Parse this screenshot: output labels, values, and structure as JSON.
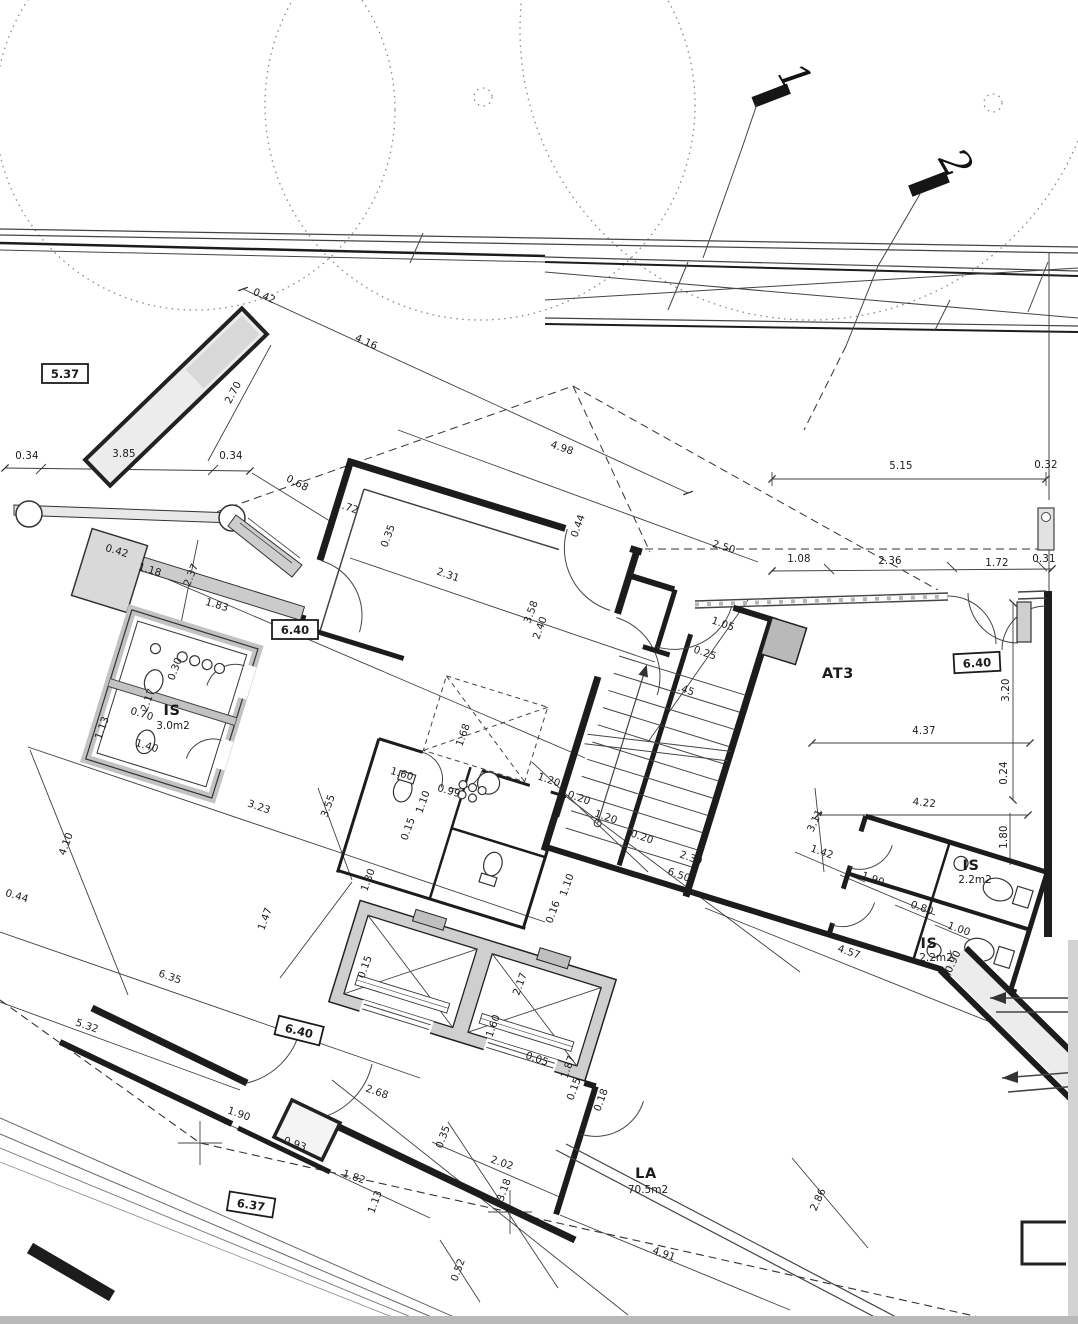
{
  "drawing": {
    "kind": "scanned architectural floor plan",
    "rooms": [
      {
        "name": "IS",
        "area": "3.0m2"
      },
      {
        "name": "AT3",
        "area": ""
      },
      {
        "name": "IS",
        "area": "2.2m2"
      },
      {
        "name": "IS",
        "area": "2.2m2"
      },
      {
        "name": "LA",
        "area": "70.5m2"
      }
    ],
    "level_markers": [
      "5.37",
      "6.40",
      "6.40",
      "6.40",
      "6.37"
    ],
    "section_markers": [
      "1",
      "2"
    ]
  },
  "labels": [
    {
      "t": "0.42",
      "x": 263,
      "y": 299,
      "r": 24,
      "cls": "dim"
    },
    {
      "t": "4.16",
      "x": 365,
      "y": 345,
      "r": 24,
      "cls": "dim"
    },
    {
      "t": "2.70",
      "x": 236,
      "y": 394,
      "r": -62,
      "cls": "dim"
    },
    {
      "t": "0.34",
      "x": 27,
      "y": 459,
      "r": 0,
      "cls": "dim"
    },
    {
      "t": "3.85",
      "x": 124,
      "y": 457,
      "r": 0,
      "cls": "dim"
    },
    {
      "t": "0.34",
      "x": 231,
      "y": 459,
      "r": 0,
      "cls": "dim"
    },
    {
      "t": "0.68",
      "x": 296,
      "y": 486,
      "r": 27,
      "cls": "dim"
    },
    {
      "t": "4.98",
      "x": 561,
      "y": 451,
      "r": 19,
      "cls": "dim"
    },
    {
      "t": "5.15",
      "x": 901,
      "y": 469,
      "r": 0,
      "cls": "dim"
    },
    {
      "t": "0.32",
      "x": 1046,
      "y": 468,
      "r": 0,
      "cls": "dim",
      "s": 8.5
    },
    {
      "t": "1.72",
      "x": 346,
      "y": 510,
      "r": 19,
      "cls": "dim"
    },
    {
      "t": "0.42",
      "x": 116,
      "y": 554,
      "r": 17,
      "cls": "dim",
      "s": 9.5
    },
    {
      "t": "1.18",
      "x": 149,
      "y": 573,
      "r": 17,
      "cls": "dim"
    },
    {
      "t": "2.37",
      "x": 194,
      "y": 576,
      "r": -68,
      "cls": "dim"
    },
    {
      "t": "1.83",
      "x": 216,
      "y": 608,
      "r": 17,
      "cls": "dim"
    },
    {
      "t": "0.35",
      "x": 391,
      "y": 537,
      "r": -70,
      "cls": "dim",
      "s": 9
    },
    {
      "t": "2.31",
      "x": 447,
      "y": 578,
      "r": 19,
      "cls": "dim"
    },
    {
      "t": "0.44",
      "x": 581,
      "y": 527,
      "r": -70,
      "cls": "dim",
      "s": 9
    },
    {
      "t": "2.50",
      "x": 723,
      "y": 550,
      "r": 17,
      "cls": "dim"
    },
    {
      "t": "1.08",
      "x": 799,
      "y": 562,
      "r": 0,
      "cls": "dim"
    },
    {
      "t": "2.36",
      "x": 890,
      "y": 564,
      "r": 0,
      "cls": "dim"
    },
    {
      "t": "1.72",
      "x": 997,
      "y": 566,
      "r": 0,
      "cls": "dim"
    },
    {
      "t": "0.31",
      "x": 1044,
      "y": 562,
      "r": 0,
      "cls": "dim",
      "s": 8.5
    },
    {
      "t": "3.58",
      "x": 534,
      "y": 613,
      "r": -70,
      "cls": "dim",
      "s": 9.5
    },
    {
      "t": "2.40",
      "x": 543,
      "y": 629,
      "r": -70,
      "cls": "dim",
      "s": 9.5
    },
    {
      "t": "1.05",
      "x": 722,
      "y": 627,
      "r": 19,
      "cls": "dim"
    },
    {
      "t": "0.25",
      "x": 704,
      "y": 656,
      "r": 19,
      "cls": "dim",
      "s": 9
    },
    {
      "t": "1.45",
      "x": 682,
      "y": 692,
      "r": 19,
      "cls": "dim"
    },
    {
      "t": "1.68",
      "x": 466,
      "y": 736,
      "r": -70,
      "cls": "dim",
      "s": 9.5
    },
    {
      "t": "0.30",
      "x": 178,
      "y": 670,
      "r": -70,
      "cls": "dim",
      "s": 9
    },
    {
      "t": "2.17",
      "x": 151,
      "y": 701,
      "r": -70,
      "cls": "dim"
    },
    {
      "t": "0.70",
      "x": 141,
      "y": 717,
      "r": 17,
      "cls": "dim",
      "s": 9
    },
    {
      "t": "1.40",
      "x": 146,
      "y": 749,
      "r": 17,
      "cls": "dim"
    },
    {
      "t": "1.13",
      "x": 105,
      "y": 729,
      "r": -70,
      "cls": "dim",
      "s": 9
    },
    {
      "t": "1.60",
      "x": 401,
      "y": 777,
      "r": 17,
      "cls": "dim",
      "s": 9
    },
    {
      "t": "0.99",
      "x": 448,
      "y": 794,
      "r": 17,
      "cls": "dim",
      "s": 9.5
    },
    {
      "t": "1.10",
      "x": 426,
      "y": 803,
      "r": -70,
      "cls": "dim",
      "s": 9.5
    },
    {
      "t": "0.15",
      "x": 411,
      "y": 830,
      "r": -70,
      "cls": "dim",
      "s": 9
    },
    {
      "t": "1.80",
      "x": 371,
      "y": 881,
      "r": -70,
      "cls": "dim"
    },
    {
      "t": "1.20",
      "x": 548,
      "y": 783,
      "r": 19,
      "cls": "dim"
    },
    {
      "t": "0.20",
      "x": 578,
      "y": 801,
      "r": 19,
      "cls": "dim"
    },
    {
      "t": "1.20",
      "x": 605,
      "y": 820,
      "r": 19,
      "cls": "dim"
    },
    {
      "t": "0.20",
      "x": 641,
      "y": 840,
      "r": 19,
      "cls": "dim",
      "s": 9
    },
    {
      "t": "1.10",
      "x": 570,
      "y": 886,
      "r": -70,
      "cls": "dim"
    },
    {
      "t": "0.16",
      "x": 556,
      "y": 913,
      "r": -70,
      "cls": "dim",
      "s": 9
    },
    {
      "t": "2.30",
      "x": 690,
      "y": 861,
      "r": 19,
      "cls": "dim",
      "s": 9.5
    },
    {
      "t": "6.50",
      "x": 678,
      "y": 878,
      "r": 19,
      "cls": "dim"
    },
    {
      "t": "3.23",
      "x": 258,
      "y": 810,
      "r": 19,
      "cls": "dim"
    },
    {
      "t": "3.55",
      "x": 331,
      "y": 807,
      "r": -70,
      "cls": "dim"
    },
    {
      "t": "4.10",
      "x": 69,
      "y": 845,
      "r": -70,
      "cls": "dim"
    },
    {
      "t": "0.44",
      "x": 16,
      "y": 899,
      "r": 17,
      "cls": "dim",
      "s": 9
    },
    {
      "t": "1.47",
      "x": 268,
      "y": 920,
      "r": -70,
      "cls": "dim"
    },
    {
      "t": "6.35",
      "x": 169,
      "y": 980,
      "r": 19,
      "cls": "dim"
    },
    {
      "t": "5.32",
      "x": 86,
      "y": 1029,
      "r": 19,
      "cls": "dim"
    },
    {
      "t": "0.15",
      "x": 368,
      "y": 968,
      "r": -70,
      "cls": "dim",
      "s": 9
    },
    {
      "t": "2.17",
      "x": 523,
      "y": 985,
      "r": -70,
      "cls": "dim"
    },
    {
      "t": "1.60",
      "x": 496,
      "y": 1027,
      "r": -70,
      "cls": "dim",
      "s": 9.5
    },
    {
      "t": "0.05",
      "x": 536,
      "y": 1062,
      "r": 19,
      "cls": "dim",
      "s": 8.5
    },
    {
      "t": "1.87",
      "x": 571,
      "y": 1068,
      "r": -70,
      "cls": "dim",
      "s": 9.5
    },
    {
      "t": "0.15",
      "x": 577,
      "y": 1090,
      "r": -70,
      "cls": "dim",
      "s": 8.5
    },
    {
      "t": "0.18",
      "x": 604,
      "y": 1101,
      "r": -70,
      "cls": "dim",
      "s": 8.5
    },
    {
      "t": "2.68",
      "x": 376,
      "y": 1095,
      "r": 19,
      "cls": "dim"
    },
    {
      "t": "0.35",
      "x": 446,
      "y": 1138,
      "r": -70,
      "cls": "dim",
      "s": 9.5
    },
    {
      "t": "2.02",
      "x": 501,
      "y": 1166,
      "r": 19,
      "cls": "dim"
    },
    {
      "t": "3.18",
      "x": 507,
      "y": 1191,
      "r": -70,
      "cls": "dim"
    },
    {
      "t": "1.82",
      "x": 353,
      "y": 1180,
      "r": 19,
      "cls": "dim"
    },
    {
      "t": "1.13",
      "x": 378,
      "y": 1203,
      "r": -70,
      "cls": "dim",
      "s": 9
    },
    {
      "t": "0.52",
      "x": 461,
      "y": 1271,
      "r": -70,
      "cls": "dim"
    },
    {
      "t": "1.90",
      "x": 238,
      "y": 1117,
      "r": 19,
      "cls": "dim"
    },
    {
      "t": "0.93",
      "x": 294,
      "y": 1147,
      "r": 19,
      "cls": "dim"
    },
    {
      "t": "4.91",
      "x": 663,
      "y": 1257,
      "r": 19,
      "cls": "dim"
    },
    {
      "t": "2.86",
      "x": 821,
      "y": 1201,
      "r": -65,
      "cls": "dim"
    },
    {
      "t": "3.11",
      "x": 818,
      "y": 822,
      "r": -65,
      "cls": "dim"
    },
    {
      "t": "4.22",
      "x": 924,
      "y": 806,
      "r": 6,
      "cls": "dim"
    },
    {
      "t": "1.42",
      "x": 821,
      "y": 855,
      "r": 19,
      "cls": "dim"
    },
    {
      "t": "1.90",
      "x": 872,
      "y": 882,
      "r": 19,
      "cls": "dim"
    },
    {
      "t": "0.80",
      "x": 921,
      "y": 911,
      "r": 19,
      "cls": "dim",
      "s": 9.5
    },
    {
      "t": "1.00",
      "x": 958,
      "y": 932,
      "r": 19,
      "cls": "dim",
      "s": 9.5
    },
    {
      "t": "4.57",
      "x": 848,
      "y": 955,
      "r": 19,
      "cls": "dim"
    },
    {
      "t": "0.90",
      "x": 956,
      "y": 963,
      "r": -65,
      "cls": "dim",
      "s": 9
    },
    {
      "t": "1.80",
      "x": 1007,
      "y": 837,
      "r": -90,
      "cls": "dim"
    },
    {
      "t": "3.20",
      "x": 1009,
      "y": 690,
      "r": -90,
      "cls": "dim"
    },
    {
      "t": "0.24",
      "x": 1007,
      "y": 773,
      "r": -90,
      "cls": "dim",
      "s": 8.5
    },
    {
      "t": "4.37",
      "x": 924,
      "y": 734,
      "r": 0,
      "cls": "dim"
    },
    {
      "t": "IS",
      "x": 172,
      "y": 715,
      "r": 0,
      "cls": "room"
    },
    {
      "t": "3.0m2",
      "x": 173,
      "y": 729,
      "r": 0,
      "cls": "area"
    },
    {
      "t": "AT3",
      "x": 838,
      "y": 678,
      "r": 0,
      "cls": "room"
    },
    {
      "t": "IS",
      "x": 971,
      "y": 870,
      "r": 0,
      "cls": "room"
    },
    {
      "t": "2.2m2",
      "x": 975,
      "y": 883,
      "r": 0,
      "cls": "area"
    },
    {
      "t": "IS",
      "x": 929,
      "y": 948,
      "r": 0,
      "cls": "room"
    },
    {
      "t": "2.2m2",
      "x": 936,
      "y": 961,
      "r": 0,
      "cls": "area"
    },
    {
      "t": "LA",
      "x": 646,
      "y": 1178,
      "r": 0,
      "cls": "room"
    },
    {
      "t": "70.5m2",
      "x": 648,
      "y": 1193,
      "r": 0,
      "cls": "area"
    },
    {
      "t": "5.37",
      "x": 65,
      "y": 374,
      "r": 0,
      "cls": "badge"
    },
    {
      "t": "6.40",
      "x": 295,
      "y": 630,
      "r": 0,
      "cls": "badge"
    },
    {
      "t": "6.40",
      "x": 977,
      "y": 663,
      "r": -3,
      "cls": "badge"
    },
    {
      "t": "6.40",
      "x": 299,
      "y": 1031,
      "r": 14,
      "cls": "badge"
    },
    {
      "t": "6.37",
      "x": 251,
      "y": 1205,
      "r": 9,
      "cls": "badge"
    },
    {
      "t": "1",
      "x": 783,
      "y": 84,
      "r": 60,
      "cls": "marker"
    },
    {
      "t": "2",
      "x": 944,
      "y": 170,
      "r": 60,
      "cls": "marker"
    }
  ]
}
